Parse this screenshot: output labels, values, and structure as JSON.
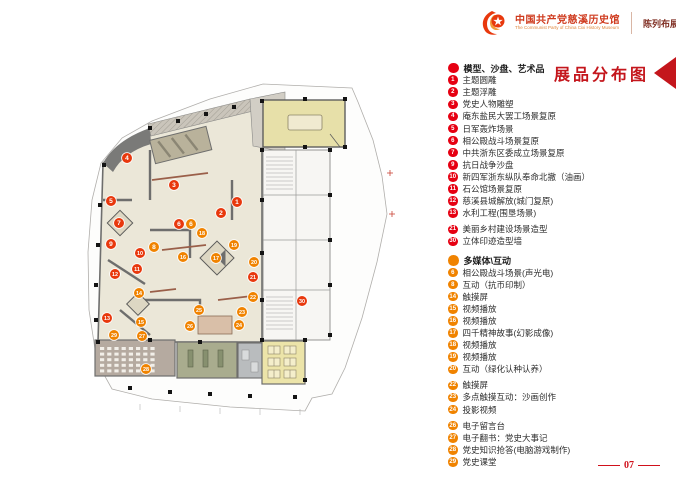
{
  "header": {
    "title_cn": "中国共产党慈溪历史馆",
    "title_en": "The Communist Party of China Cixi  History Museum",
    "subtitle": "陈列布展设计施工方案"
  },
  "legend": {
    "title": "展品分布图",
    "sections": [
      {
        "color": "#e60012",
        "category": "模型、沙盘、艺术品",
        "items": [
          {
            "num": "1",
            "label": "主题圆雕"
          },
          {
            "num": "2",
            "label": "主题浮雕"
          },
          {
            "num": "3",
            "label": "党史人物雕塑"
          },
          {
            "num": "4",
            "label": "庵东盐民大罢工场景复原"
          },
          {
            "num": "5",
            "label": "日军轰炸场景"
          },
          {
            "num": "6",
            "label": "相公殿战斗场景复原"
          },
          {
            "num": "7",
            "label": "中共浙东区委成立场景复原"
          },
          {
            "num": "9",
            "label": "抗日战争沙盘"
          },
          {
            "num": "10",
            "label": "新四军浙东纵队奉命北撤（油画）"
          },
          {
            "num": "11",
            "label": "石公馆场景复原"
          },
          {
            "num": "12",
            "label": "慈溪县城解放(城门复原)"
          },
          {
            "num": "13",
            "label": "水利工程(围垦场景)"
          },
          {
            "num": "21",
            "label": "美丽乡村建设场景造型",
            "gap": true
          },
          {
            "num": "30",
            "label": "立体印迹造型墙"
          }
        ]
      },
      {
        "color": "#f08300",
        "category": "多媒体\\互动",
        "items": [
          {
            "num": "6",
            "label": "相公殿战斗场景(声光电)"
          },
          {
            "num": "8",
            "label": "互动（抗币印制）"
          },
          {
            "num": "14",
            "label": "触摸屏"
          },
          {
            "num": "15",
            "label": "视频播放"
          },
          {
            "num": "16",
            "label": "视频播放"
          },
          {
            "num": "17",
            "label": "四千精神故事(幻影成像)"
          },
          {
            "num": "18",
            "label": "视频播放"
          },
          {
            "num": "19",
            "label": "视频播放"
          },
          {
            "num": "20",
            "label": "互动（绿化认种认养）"
          },
          {
            "num": "22",
            "label": "触摸屏",
            "gap": true
          },
          {
            "num": "23",
            "label": "多点触摸互动：沙画创作"
          },
          {
            "num": "24",
            "label": "投影视频"
          },
          {
            "num": "26",
            "label": "电子留言台",
            "gap": true
          },
          {
            "num": "27",
            "label": "电子翻书：党史大事记"
          },
          {
            "num": "28",
            "label": "党史知识抢答(电脑游戏制作)"
          },
          {
            "num": "29",
            "label": "党史课堂"
          }
        ]
      }
    ]
  },
  "plan": {
    "marker_colors": {
      "red": "#e8380d",
      "orange": "#f08300"
    },
    "markers": [
      {
        "num": "1",
        "color": "red",
        "x": 237,
        "y": 202
      },
      {
        "num": "2",
        "color": "red",
        "x": 221,
        "y": 213
      },
      {
        "num": "3",
        "color": "red",
        "x": 174,
        "y": 185
      },
      {
        "num": "4",
        "color": "red",
        "x": 127,
        "y": 158
      },
      {
        "num": "5",
        "color": "red",
        "x": 111,
        "y": 201
      },
      {
        "num": "6",
        "color": "red",
        "x": 179,
        "y": 224
      },
      {
        "num": "7",
        "color": "red",
        "x": 119,
        "y": 223
      },
      {
        "num": "9",
        "color": "red",
        "x": 111,
        "y": 244
      },
      {
        "num": "10",
        "color": "red",
        "x": 140,
        "y": 253
      },
      {
        "num": "11",
        "color": "red",
        "x": 137,
        "y": 269
      },
      {
        "num": "12",
        "color": "red",
        "x": 115,
        "y": 274
      },
      {
        "num": "13",
        "color": "red",
        "x": 107,
        "y": 318
      },
      {
        "num": "21",
        "color": "red",
        "x": 253,
        "y": 277
      },
      {
        "num": "30",
        "color": "red",
        "x": 302,
        "y": 301
      },
      {
        "num": "6",
        "color": "orange",
        "x": 191,
        "y": 224
      },
      {
        "num": "8",
        "color": "orange",
        "x": 154,
        "y": 247
      },
      {
        "num": "14",
        "color": "orange",
        "x": 139,
        "y": 293
      },
      {
        "num": "15",
        "color": "orange",
        "x": 141,
        "y": 322
      },
      {
        "num": "16",
        "color": "orange",
        "x": 183,
        "y": 257
      },
      {
        "num": "17",
        "color": "orange",
        "x": 216,
        "y": 258
      },
      {
        "num": "18",
        "color": "orange",
        "x": 202,
        "y": 233
      },
      {
        "num": "19",
        "color": "orange",
        "x": 234,
        "y": 245
      },
      {
        "num": "20",
        "color": "orange",
        "x": 254,
        "y": 262
      },
      {
        "num": "22",
        "color": "orange",
        "x": 253,
        "y": 297
      },
      {
        "num": "23",
        "color": "orange",
        "x": 242,
        "y": 312
      },
      {
        "num": "24",
        "color": "orange",
        "x": 239,
        "y": 325
      },
      {
        "num": "25",
        "color": "orange",
        "x": 199,
        "y": 310
      },
      {
        "num": "26",
        "color": "orange",
        "x": 190,
        "y": 326
      },
      {
        "num": "27",
        "color": "orange",
        "x": 142,
        "y": 336
      },
      {
        "num": "28",
        "color": "orange",
        "x": 146,
        "y": 369
      },
      {
        "num": "29",
        "color": "orange",
        "x": 114,
        "y": 335
      }
    ]
  },
  "footer": {
    "page": "07"
  }
}
